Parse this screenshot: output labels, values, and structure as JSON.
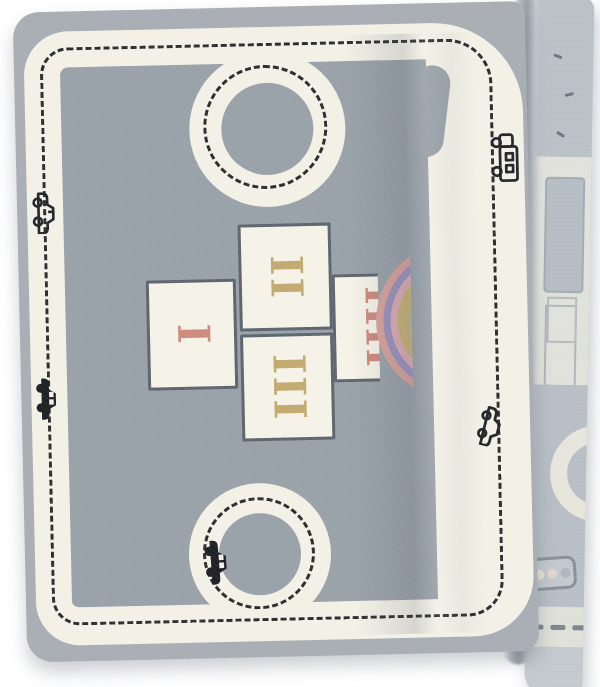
{
  "scene": {
    "description": "Product photograph of a grey children's road play rug folded over along its right edge on a white background",
    "background_color": "#ffffff"
  },
  "rug": {
    "front": {
      "field_color": "#99a1a9",
      "edge_border_color": "#a9aeb4",
      "road_color": "#f3f0e6",
      "road_dash_color": "#2b2e31",
      "roundabout_count": 2,
      "hopscotch_squares": [
        {
          "numeral": "I",
          "color": "#cd8a7d"
        },
        {
          "numeral": "II",
          "color": "#c2aa70"
        },
        {
          "numeral": "III",
          "color": "#c2aa70"
        },
        {
          "numeral": "IIII",
          "color": "#cd8a7d"
        }
      ],
      "rainbow_colors_outer_to_inner": [
        "#d8a29b",
        "#9c92bd",
        "#dcacb2",
        "#c8b277",
        "#9db8ad"
      ],
      "vehicles": [
        {
          "icon": "car-icon",
          "style": "outline",
          "location": "left-road-upper"
        },
        {
          "icon": "car-icon",
          "style": "solid",
          "location": "left-road-middle"
        },
        {
          "icon": "truck-icon",
          "style": "outline",
          "location": "right-road-upper"
        },
        {
          "icon": "car-icon",
          "style": "outline",
          "location": "right-road-lower"
        },
        {
          "icon": "car-icon",
          "style": "solid",
          "location": "bottom-roundabout"
        }
      ]
    },
    "back": {
      "base_color": "#ccd1d6",
      "pale_road_color": "#e7e5db",
      "features": [
        "traffic-light-icon",
        "pale-road-arc",
        "dashed-road",
        "building-outlines"
      ]
    }
  }
}
